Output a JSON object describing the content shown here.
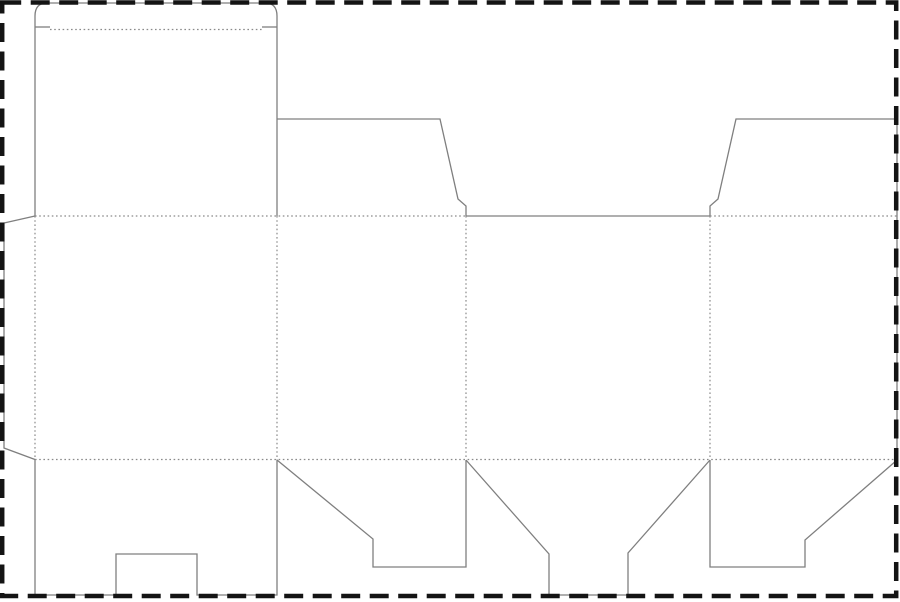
{
  "canvas": {
    "width": 900,
    "height": 602,
    "background": "#ffffff"
  },
  "colors": {
    "cut_line": "#7f7f7f",
    "fold_line": "#8a8a8a",
    "border": "#141414",
    "background": "#ffffff"
  },
  "strokes": {
    "cut_width": 1.3,
    "fold_width": 1.2,
    "fold_dash": "1.6 2.6",
    "border_width": 4.5,
    "border_dash": "19 9.5"
  },
  "border_rect": {
    "x": 2.2,
    "y": 2.5,
    "width": 894,
    "height": 593.5
  },
  "dieline": {
    "cut_paths": [
      {
        "name": "glue-flap-outline",
        "d": "M 35,216 L 4,223 L 4,448 L 35,459.5"
      },
      {
        "name": "tuck-flap-and-lid-outline",
        "d": "M 35,216 L 35,16 Q 35,3 47,3 L 265,3 Q 277,3 277,16 L 277,216"
      },
      {
        "name": "tuck-shoulder-left",
        "d": "M 35,27 L 50,27"
      },
      {
        "name": "tuck-shoulder-right",
        "d": "M 262,27 L 277,27"
      },
      {
        "name": "top-dust-flap-left",
        "d": "M 277,119 L 440,119 L 458,199 L 466,206 L 466,216"
      },
      {
        "name": "back-panel-top-edge",
        "d": "M 466,216 L 710,216"
      },
      {
        "name": "top-dust-flap-right",
        "d": "M 710,216 L 710,206 L 718,199 L 736,119 L 897,119 L 897,459.5"
      },
      {
        "name": "bottom-flap-notched",
        "d": "M 35,459.5 L 35,595 L 116,595 L 116,554 L 197,554 L 197,595 L 277,595 L 277,459.5"
      },
      {
        "name": "bottom-flap-step-left",
        "d": "M 277,460 L 373,539 L 373,567 L 466,567 L 466,460"
      },
      {
        "name": "bottom-flap-snaplock",
        "d": "M 466,460 L 549,554 L 549,595 L 628,595 L 628,553 L 710,460"
      },
      {
        "name": "bottom-flap-step-right",
        "d": "M 710,460 L 710,567 L 805,567 L 805,540 L 897,460"
      }
    ],
    "fold_lines": [
      {
        "name": "tuck-flap-fold",
        "d": "M 50,29.5 L 262,29.5"
      },
      {
        "name": "top-fold-row-left",
        "d": "M 35,216 L 466,216"
      },
      {
        "name": "top-fold-row-right",
        "d": "M 710,216 L 897,216"
      },
      {
        "name": "bottom-fold-row",
        "d": "M 35,459.5 L 897,459.5"
      },
      {
        "name": "glue-flap-fold",
        "d": "M 35,216 L 35,459.5"
      },
      {
        "name": "panel-fold-1",
        "d": "M 277,216 L 277,459.5"
      },
      {
        "name": "panel-fold-2",
        "d": "M 466,216 L 466,459.5"
      },
      {
        "name": "panel-fold-3",
        "d": "M 710,216 L 710,459.5"
      }
    ]
  }
}
